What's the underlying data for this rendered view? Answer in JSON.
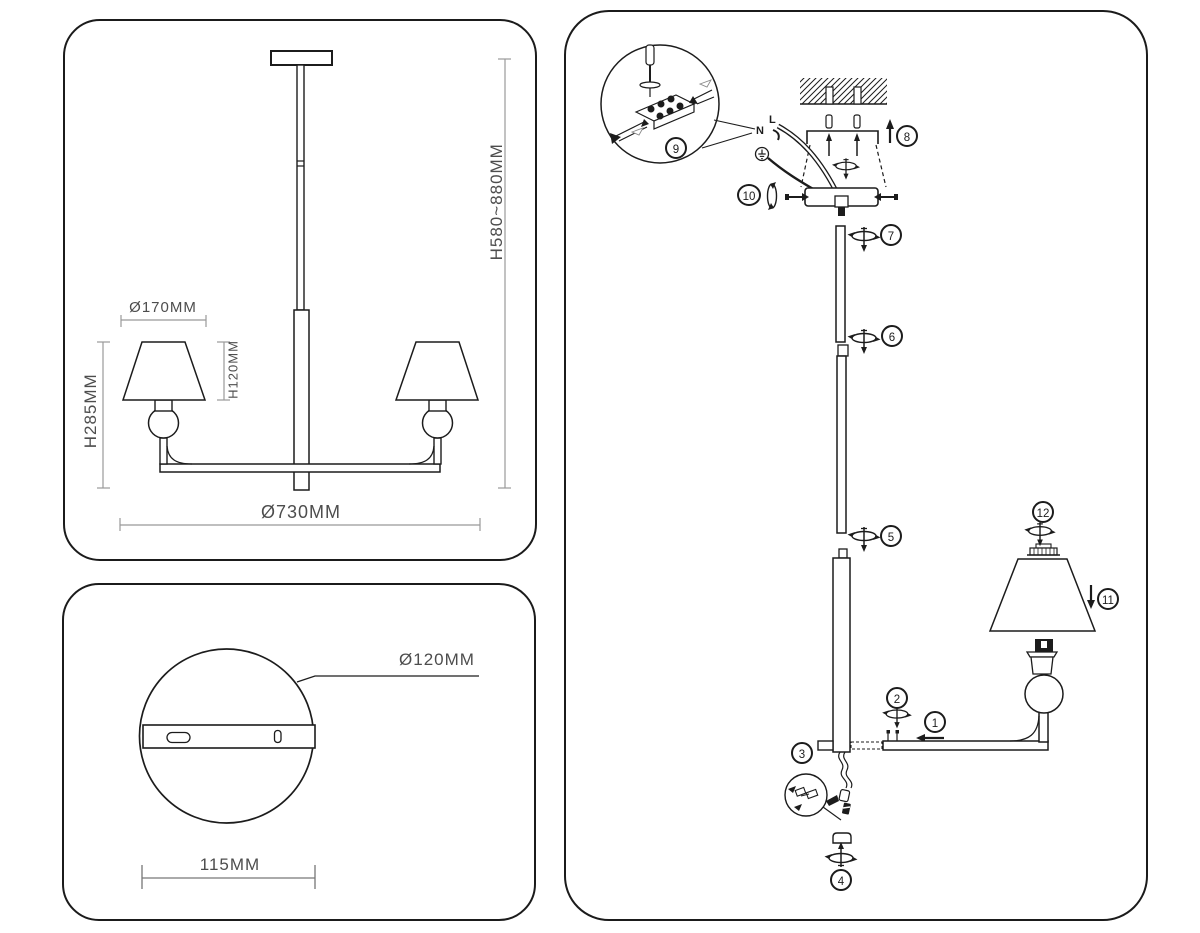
{
  "front": {
    "shade_diameter": "Ø170MM",
    "shade_height": "H120MM",
    "arm_height": "H285MM",
    "fixture_diameter": "Ø730MM",
    "overall_height": "H580~880MM"
  },
  "canopy": {
    "diameter": "Ø120MM",
    "hole_spacing": "115MM"
  },
  "assembly": {
    "wire_neutral": "N",
    "wire_live": "L",
    "steps": [
      "1",
      "2",
      "3",
      "4",
      "5",
      "6",
      "7",
      "8",
      "9",
      "10",
      "11",
      "12"
    ]
  },
  "colors": {
    "line": "#1c1c1c",
    "dimension": "#969696",
    "background": "#ffffff"
  }
}
